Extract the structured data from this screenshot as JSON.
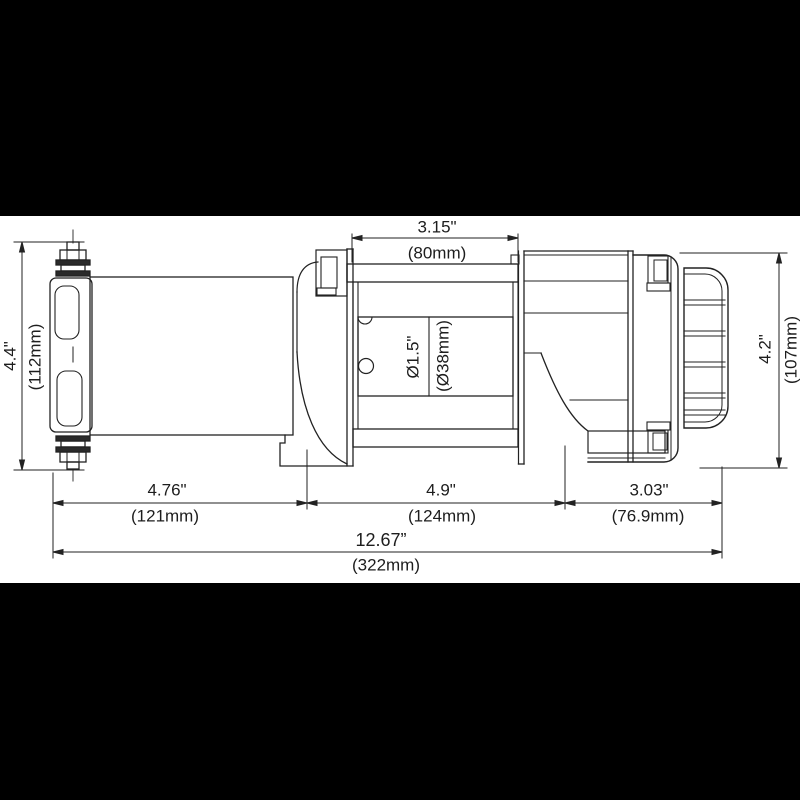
{
  "drawing": {
    "title": "winch-technical-drawing",
    "view": "side elevation with dimensions",
    "colors": {
      "line": "#222222",
      "background": "#ffffff",
      "outer_matte": "#000000"
    },
    "labels": {
      "top_width": {
        "in": "3.15\"",
        "mm": "(80mm)"
      },
      "left_height": {
        "in": "4.4\"",
        "mm": "(112mm)"
      },
      "right_height": {
        "in": "4.2\"",
        "mm": "(107mm)"
      },
      "drum_diameter": {
        "in": "Ø1.5\"",
        "mm": "(Ø38mm)"
      },
      "seg_motor": {
        "in": "4.76\"",
        "mm": "(121mm)"
      },
      "seg_drum": {
        "in": "4.9\"",
        "mm": "(124mm)"
      },
      "seg_gearbox": {
        "in": "3.03\"",
        "mm": "(76.9mm)"
      },
      "overall": {
        "in": "12.67”",
        "mm": "(322mm)"
      }
    }
  }
}
